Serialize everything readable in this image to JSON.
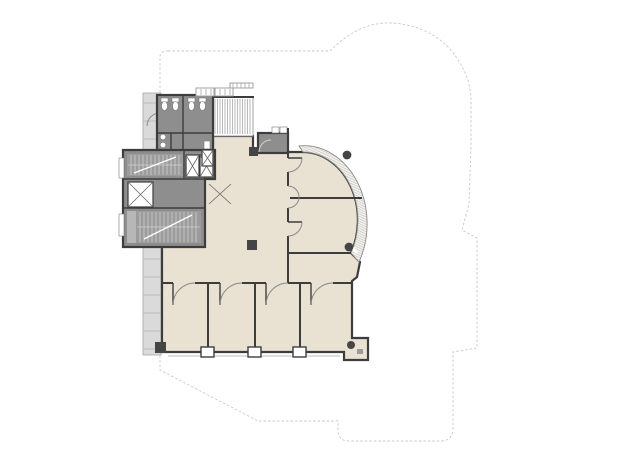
{
  "page": {
    "background": "#ffffff",
    "kind": "architectural-floor-plan",
    "visible_text": []
  },
  "colors": {
    "outline": "#c9c9c9",
    "floor": "#e9e2d2",
    "wall": "#3d3d3d",
    "service": "#8e8e8e",
    "stair": "#9c9c9c",
    "band": "#dadada",
    "tread": "#cfcfcf",
    "hatch": "#9a9a9a",
    "swing": "#8a8a8a",
    "column": "#454545"
  },
  "features": [
    "dashed-building-footprint-outline",
    "left-facade-band-with-window-ticks",
    "beige-upper-floor-plate",
    "restroom-block-with-fixtures",
    "upper-stairwell",
    "lower-stairwell",
    "single-elevator-shaft",
    "double-elevator-bank",
    "lobby-double-doors",
    "louvered-skylight-strip",
    "dark-service-room-top-right",
    "curved-curtain-wall-rotunda",
    "two-rotunda-rooms",
    "four-office-rooms-with-door-swings",
    "corridor",
    "round-and-square-columns",
    "bottom-window-sill-details"
  ]
}
